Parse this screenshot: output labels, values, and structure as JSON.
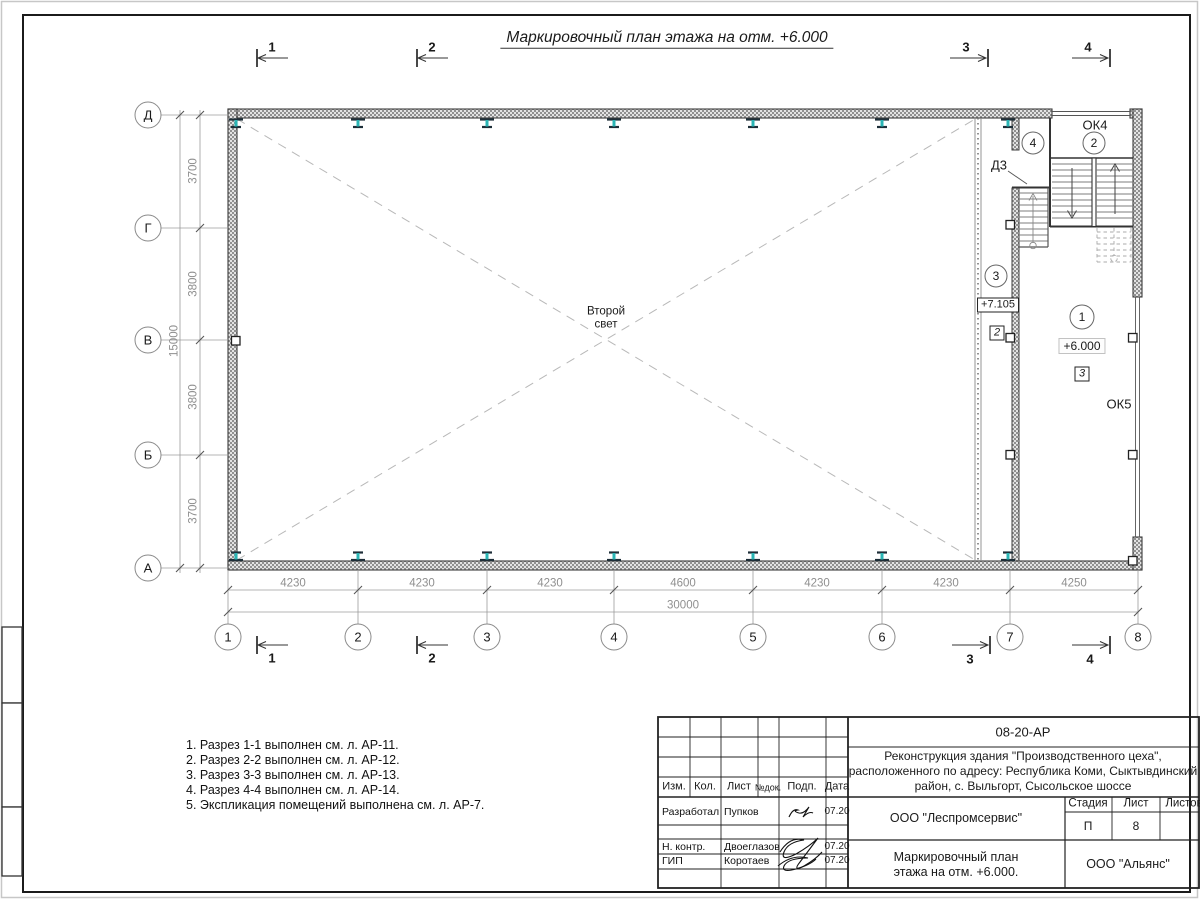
{
  "sheet": {
    "title": "Маркировочный план этажа на отм. +6.000"
  },
  "plan": {
    "second_light_line1": "Второй",
    "second_light_line2": "свет",
    "axes_bottom": [
      "1",
      "2",
      "3",
      "4",
      "5",
      "6",
      "7",
      "8"
    ],
    "axes_left": [
      "Д",
      "Г",
      "В",
      "Б",
      "А"
    ],
    "dims_bottom": [
      "4230",
      "4230",
      "4230",
      "4600",
      "4230",
      "4230",
      "4250"
    ],
    "dim_bottom_total": "30000",
    "dims_left": [
      "3700",
      "3800",
      "3800",
      "3700"
    ],
    "dim_left_total": "15000",
    "section_marks": [
      "1",
      "2",
      "3",
      "4"
    ],
    "room_numbers": [
      "1",
      "2",
      "3",
      "4"
    ],
    "window_ok4": "ОК4",
    "window_ok5": "ОК5",
    "door_d3": "Д3",
    "elev_upper": "+7.105",
    "elev_main": "+6.000",
    "finish_mark_2": "2",
    "finish_mark_3": "3"
  },
  "notes": [
    "1. Разрез 1-1 выполнен см. л. АР-11.",
    "2. Разрез 2-2 выполнен см. л. АР-12.",
    "3. Разрез 3-3 выполнен см. л. АР-13.",
    "4. Разрез 4-4 выполнен см. л. АР-14.",
    "5. Экспликация помещений выполнена см. л. АР-7."
  ],
  "titleblock": {
    "doc_number": "08-20-АР",
    "project_line1": "Реконструкция здания \"Производственного цеха\",",
    "project_line2": "расположенного по адресу: Республика Коми, Сыктывдинский",
    "project_line3": "район, с. Выльгорт, Сысольское шоссе",
    "col_izm": "Изм.",
    "col_kol": "Кол.",
    "col_list": "Лист",
    "col_ndok": "№док.",
    "col_podp": "Подп.",
    "col_data": "Дата",
    "rows": [
      {
        "role": "Разработал",
        "name": "Пупков",
        "date": "07.20"
      },
      {
        "role": "Н. контр.",
        "name": "Двоеглазов",
        "date": "07.20"
      },
      {
        "role": "ГИП",
        "name": "Коротаев",
        "date": "07.20"
      }
    ],
    "org_design": "ООО \"Леспромсервис\"",
    "drawing_line1": "Маркировочный план",
    "drawing_line2": "этажа на отм. +6.000.",
    "org_client": "ООО \"Альянс\"",
    "stage_label": "Стадия",
    "sheet_label": "Лист",
    "sheets_label": "Листов",
    "stage_value": "П",
    "sheet_value": "8"
  },
  "colors": {
    "column_steel": "#2ab5b5",
    "wall_hatch": "#8f8f8f",
    "dim_gray": "#8f8f8f"
  }
}
